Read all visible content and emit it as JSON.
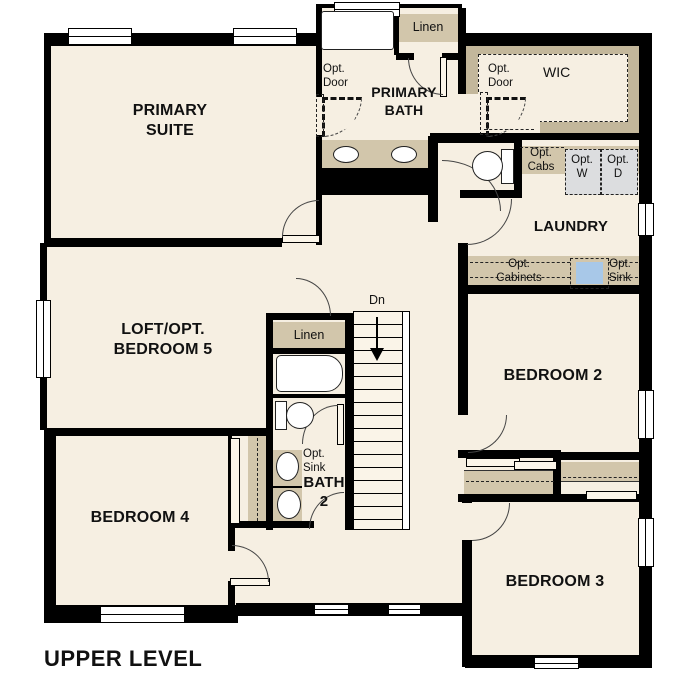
{
  "page_title": "UPPER LEVEL",
  "colors": {
    "floor": "#f6efe2",
    "cabinet_tan": "#d2c6ab",
    "wic_tan": "#c3b79b",
    "fixture_blue": "#a8c8e8",
    "appliance_gray": "#dcdddf",
    "wall_black": "#000000"
  },
  "rooms": {
    "primary_suite": {
      "line1": "PRIMARY",
      "line2": "SUITE"
    },
    "primary_bath": {
      "line1": "PRIMARY",
      "line2": "BATH"
    },
    "wic": {
      "label": "WIC"
    },
    "laundry": {
      "label": "LAUNDRY"
    },
    "loft": {
      "line1": "LOFT/OPT.",
      "line2": "BEDROOM 5"
    },
    "bedroom_2": {
      "label": "BEDROOM 2"
    },
    "bedroom_3": {
      "label": "BEDROOM 3"
    },
    "bedroom_4": {
      "label": "BEDROOM 4"
    },
    "bath_2": {
      "line1": "BATH",
      "line2": "2"
    }
  },
  "closets": {
    "linen_upper": {
      "label": "Linen"
    },
    "linen_hall": {
      "label": "Linen"
    }
  },
  "options": {
    "opt_door_bath": {
      "line1": "Opt.",
      "line2": "Door"
    },
    "opt_door_wic": {
      "line1": "Opt.",
      "line2": "Door"
    },
    "opt_cabs": {
      "line1": "Opt.",
      "line2": "Cabs"
    },
    "opt_washer": {
      "line1": "Opt.",
      "line2": "W"
    },
    "opt_dryer": {
      "line1": "Opt.",
      "line2": "D"
    },
    "opt_cabinets": {
      "line1": "Opt.",
      "line2": "Cabinets"
    },
    "opt_sink_laundry": {
      "line1": "Opt.",
      "line2": "Sink"
    },
    "opt_sink_bath2": {
      "line1": "Opt.",
      "line2": "Sink"
    }
  },
  "stairs": {
    "down_label": "Dn"
  }
}
